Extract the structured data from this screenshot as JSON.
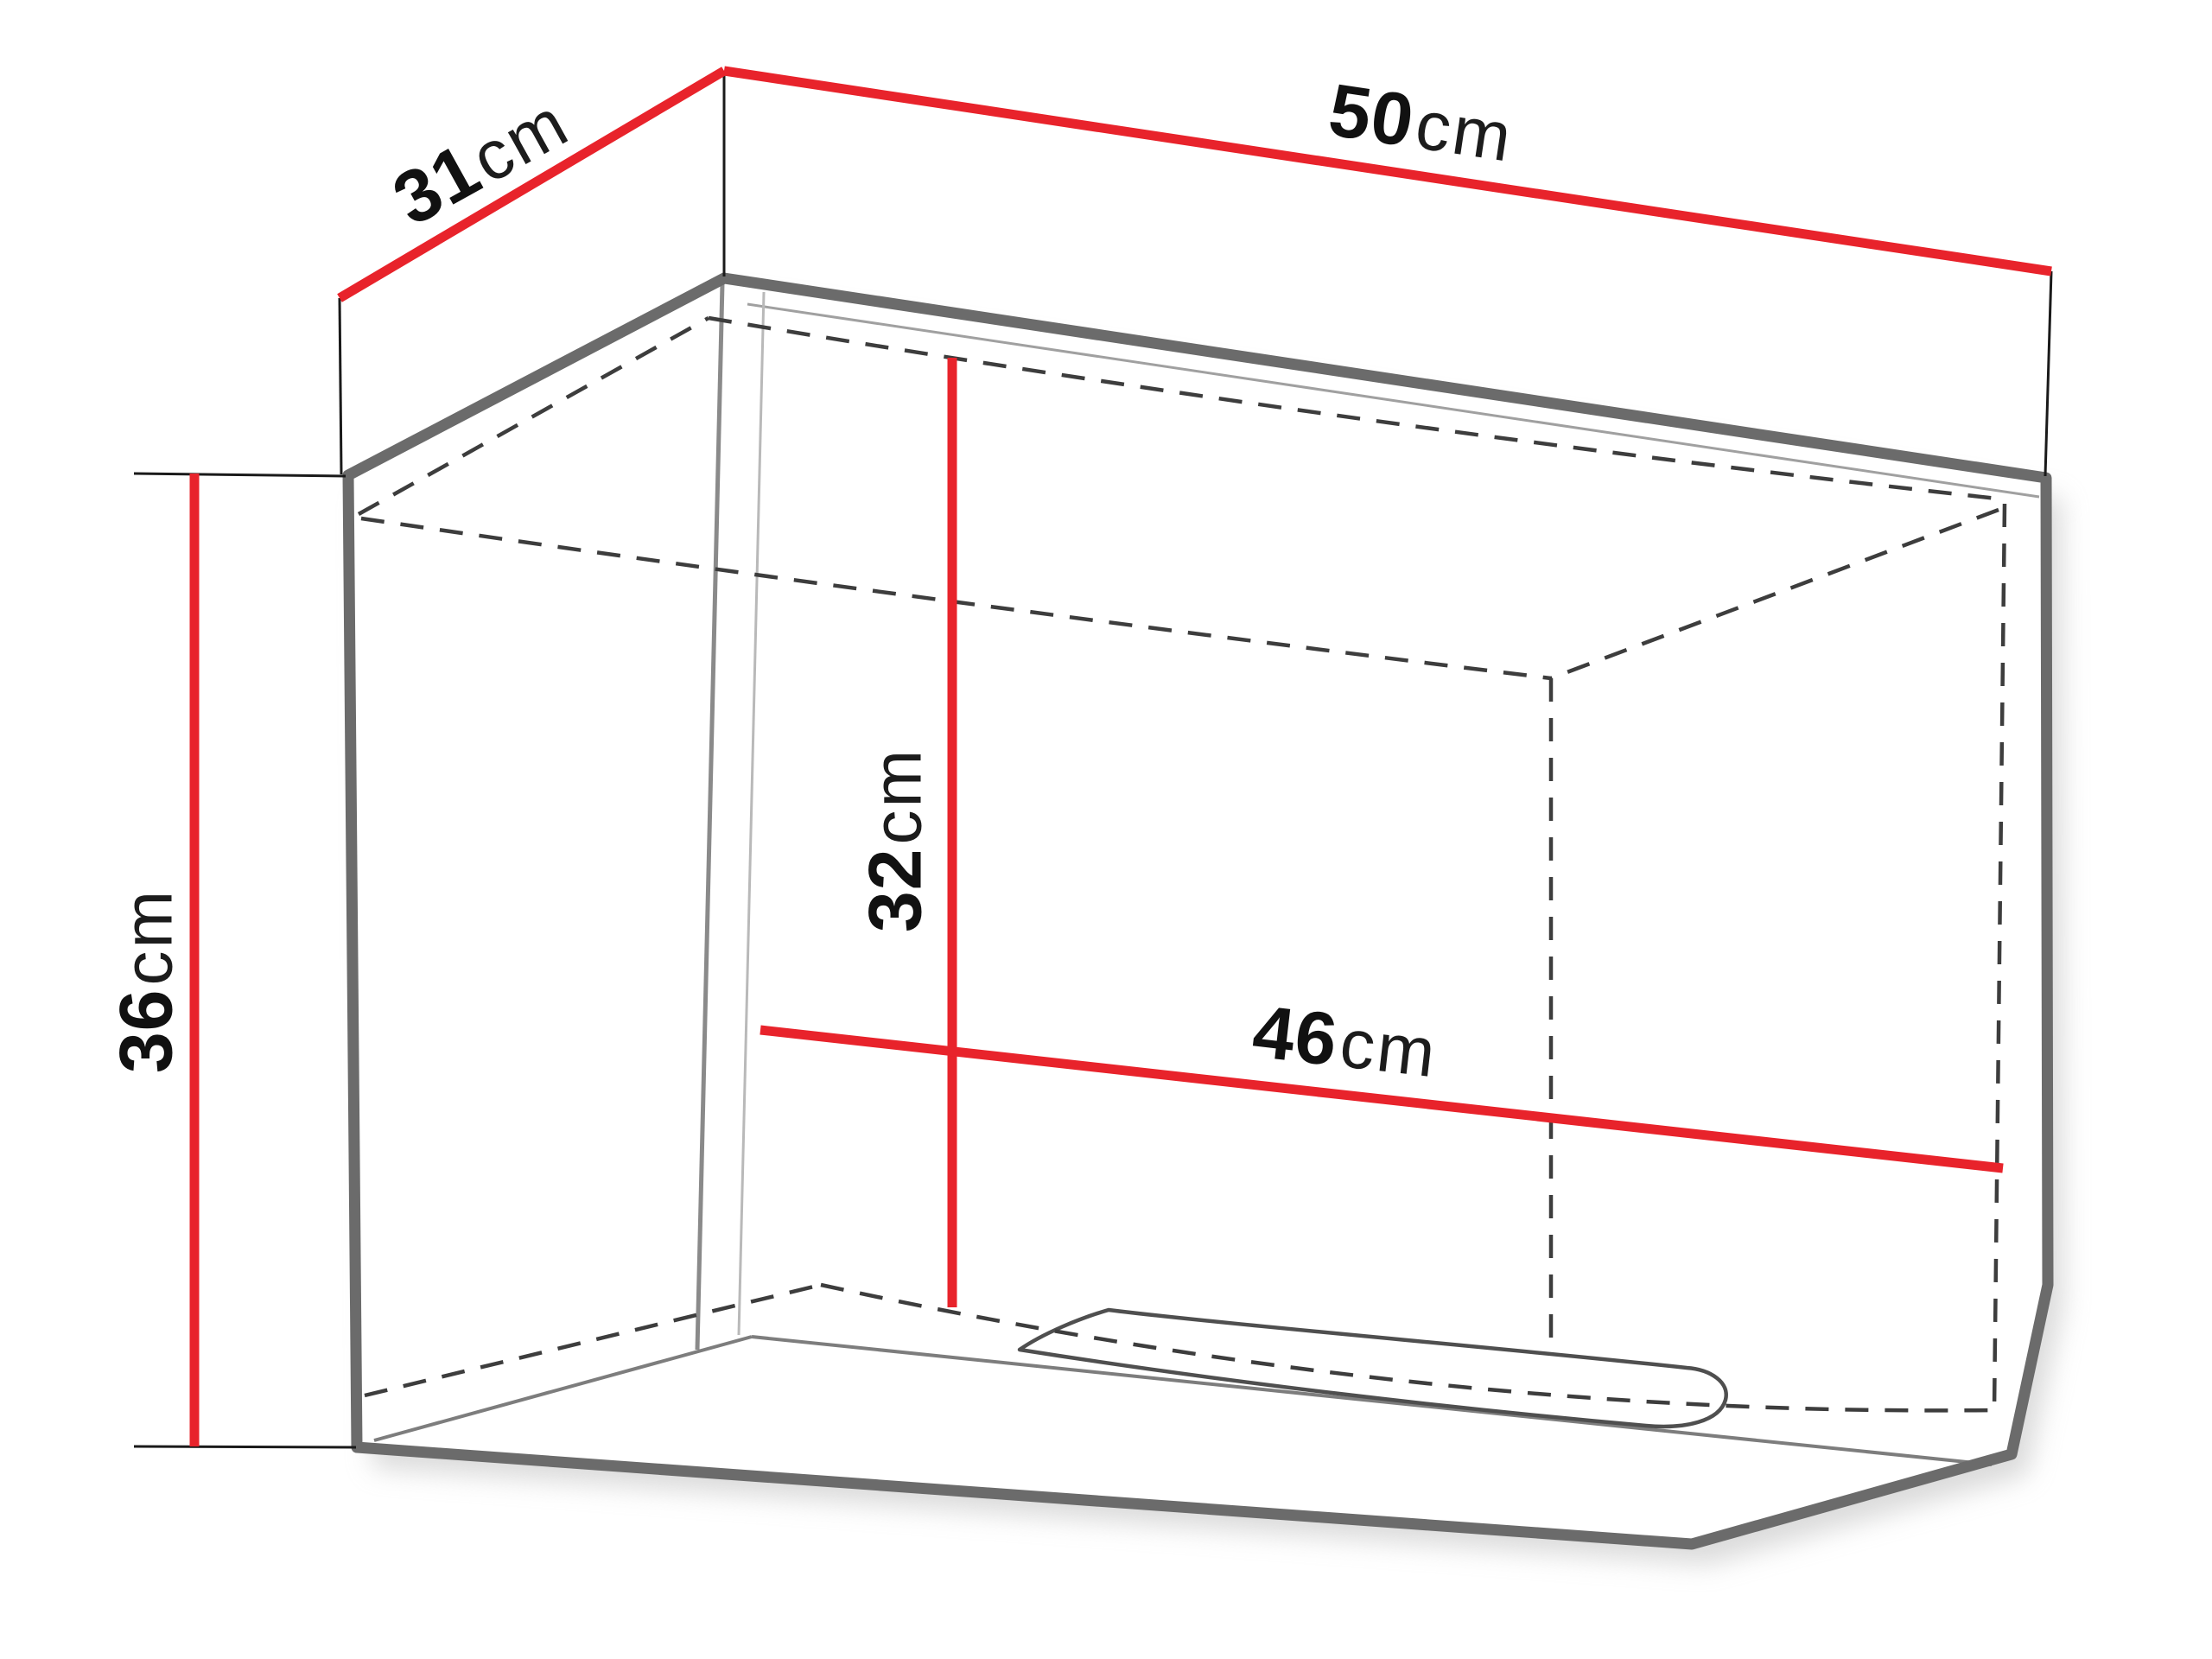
{
  "diagram": {
    "type": "furniture-dimension-drawing",
    "subject": "wall-cabinet-with-flap-door",
    "unit": "cm",
    "dimensions": {
      "width": {
        "value": "50",
        "unit": "cm"
      },
      "depth": {
        "value": "31",
        "unit": "cm"
      },
      "height": {
        "value": "36",
        "unit": "cm"
      },
      "inner_height": {
        "value": "32",
        "unit": "cm"
      },
      "inner_width": {
        "value": "46",
        "unit": "cm"
      }
    },
    "colors": {
      "dimension_line": "#e8232b",
      "extension_line": "#1a1a1a",
      "outline": "#6b6b6b",
      "hidden_edge": "#3d3d3d",
      "interior_edge": "#7d7d7d",
      "interior_edge_light": "#b9b9b9",
      "background": "#ffffff"
    }
  }
}
